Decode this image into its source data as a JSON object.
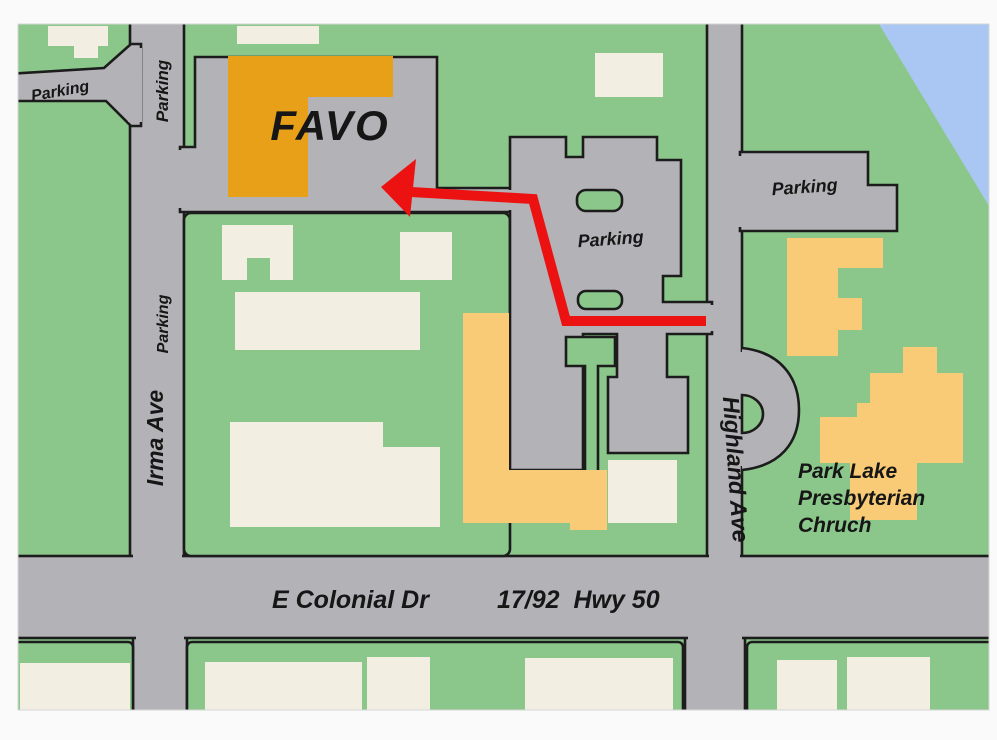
{
  "colors": {
    "green": "#8bc78b",
    "road": "#b3b2b6",
    "outline": "#1c1c1c",
    "cream": "#f2eee2",
    "orange": "#e8a018",
    "yellow": "#f9cb76",
    "water": "#a9c7f2",
    "route": "#ec1212",
    "label": "#161616"
  },
  "labels": {
    "favo": "FAVO",
    "parking_west": "Parking",
    "parking_road_north": "Parking",
    "parking_road_mid": "Parking",
    "parking_central_lot": "Parking",
    "parking_east_lot": "Parking",
    "irma_ave": "Irma Ave",
    "highland_ave": "Highland Ave",
    "e_colonial_dr": "E Colonial Dr",
    "hwy": "17/92  Hwy 50",
    "church": {
      "line1": "Park Lake",
      "line2": "Presbyterian",
      "line3": "Chruch"
    }
  }
}
